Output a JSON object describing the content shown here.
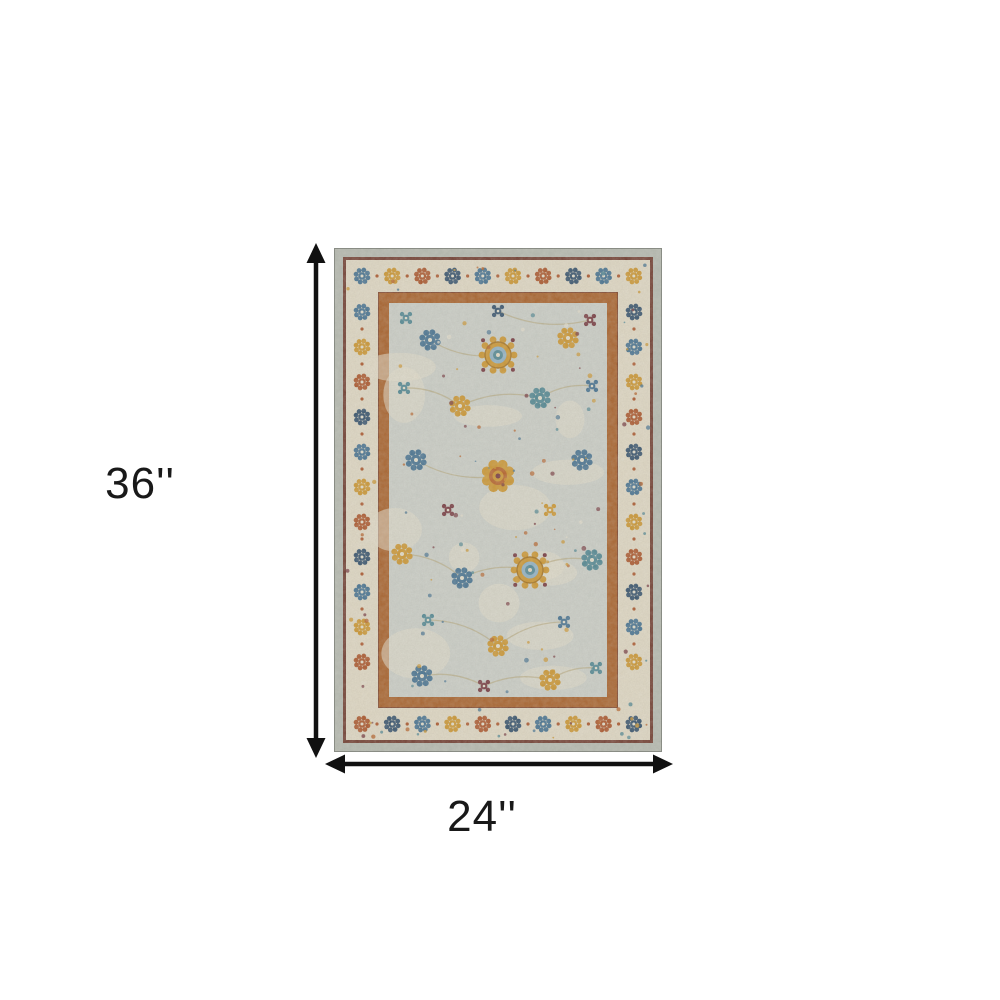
{
  "page": {
    "background": "#ffffff"
  },
  "diagram": {
    "height_label": "36''",
    "width_label": "24''",
    "arrow_color": "#111111"
  },
  "rug": {
    "style": "distressed oriental area rug, light gray field, ivory floral border, multicolor rosette motifs",
    "palette": {
      "gray_edge": "#b3b8af",
      "maroon_line": "#6e3a2e",
      "ivory_band": "#ddd6c2",
      "rust_guard": "#a6602a",
      "field": "#c8ccc5",
      "ivory_patch": "#e0dbc9",
      "gold": "#c99430",
      "gold_dark": "#a3711f",
      "orange": "#b4622a",
      "rust": "#a9552b",
      "blue": "#44708f",
      "light_blue": "#8fb0c2",
      "navy": "#33506b",
      "teal": "#4f8591",
      "maroon": "#74383f",
      "vine": "#b1a175"
    },
    "border_motif_colors": [
      "blue",
      "gold",
      "rust",
      "navy"
    ],
    "field_motifs": [
      {
        "t": "medallion",
        "x": 164,
        "y": 107
      },
      {
        "t": "rosette",
        "x": 96,
        "y": 92,
        "c": "blue"
      },
      {
        "t": "rosette",
        "x": 234,
        "y": 90,
        "c": "gold"
      },
      {
        "t": "flower",
        "x": 72,
        "y": 70,
        "c": "teal"
      },
      {
        "t": "flower",
        "x": 256,
        "y": 72,
        "c": "maroon"
      },
      {
        "t": "flower",
        "x": 164,
        "y": 63,
        "c": "navy"
      },
      {
        "t": "flower",
        "x": 70,
        "y": 140,
        "c": "teal"
      },
      {
        "t": "rosette",
        "x": 126,
        "y": 158,
        "c": "gold"
      },
      {
        "t": "rosette",
        "x": 206,
        "y": 150,
        "c": "teal"
      },
      {
        "t": "flower",
        "x": 258,
        "y": 138,
        "c": "blue"
      },
      {
        "t": "medallion2",
        "x": 164,
        "y": 228
      },
      {
        "t": "rosette",
        "x": 82,
        "y": 212,
        "c": "blue"
      },
      {
        "t": "rosette",
        "x": 248,
        "y": 212,
        "c": "blue"
      },
      {
        "t": "flower",
        "x": 114,
        "y": 262,
        "c": "maroon"
      },
      {
        "t": "flower",
        "x": 216,
        "y": 262,
        "c": "gold"
      },
      {
        "t": "rosette",
        "x": 68,
        "y": 306,
        "c": "gold"
      },
      {
        "t": "rosette",
        "x": 128,
        "y": 330,
        "c": "blue"
      },
      {
        "t": "medallion",
        "x": 196,
        "y": 322
      },
      {
        "t": "rosette",
        "x": 258,
        "y": 312,
        "c": "teal"
      },
      {
        "t": "flower",
        "x": 94,
        "y": 372,
        "c": "teal"
      },
      {
        "t": "rosette",
        "x": 164,
        "y": 398,
        "c": "gold"
      },
      {
        "t": "flower",
        "x": 230,
        "y": 374,
        "c": "blue"
      },
      {
        "t": "rosette",
        "x": 88,
        "y": 428,
        "c": "blue"
      },
      {
        "t": "flower",
        "x": 150,
        "y": 438,
        "c": "maroon"
      },
      {
        "t": "rosette",
        "x": 216,
        "y": 432,
        "c": "gold"
      },
      {
        "t": "flower",
        "x": 262,
        "y": 420,
        "c": "teal"
      }
    ]
  }
}
